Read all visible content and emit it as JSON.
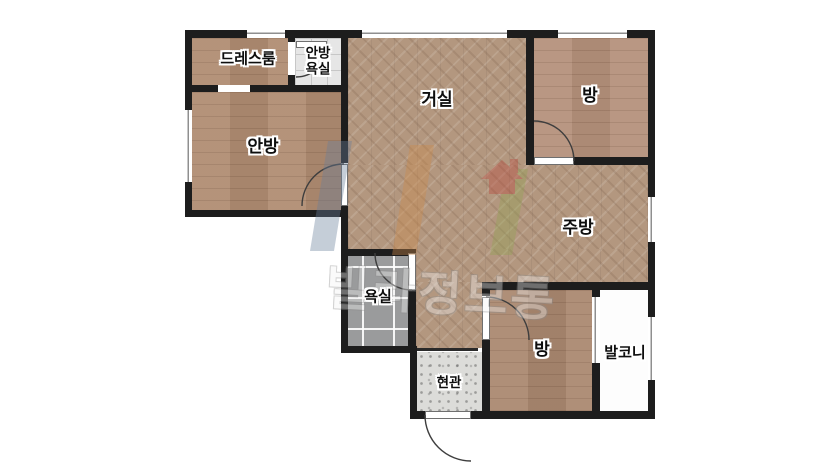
{
  "floorplan": {
    "rooms": [
      {
        "id": "dressroom",
        "label": "드레스룸",
        "floor": "wood-plank"
      },
      {
        "id": "master-bathroom",
        "label": "안방\n욕실",
        "floor": "white-tile"
      },
      {
        "id": "living-room",
        "label": "거실",
        "floor": "herringbone-wood"
      },
      {
        "id": "bedroom-ne",
        "label": "방",
        "floor": "wood-plank"
      },
      {
        "id": "master-bedroom",
        "label": "안방",
        "floor": "wood-plank"
      },
      {
        "id": "kitchen",
        "label": "주방",
        "floor": "herringbone-wood"
      },
      {
        "id": "bathroom",
        "label": "욕실",
        "floor": "gray-tile"
      },
      {
        "id": "bedroom-s",
        "label": "방",
        "floor": "wood-plank"
      },
      {
        "id": "balcony",
        "label": "발코니",
        "floor": "none"
      },
      {
        "id": "entrance",
        "label": "현관",
        "floor": "terrazzo"
      }
    ],
    "watermark": {
      "text": "빌라정보통"
    },
    "colors": {
      "wall": "#1d1d1d",
      "wood_plank": "#b08c72",
      "herringbone": "#b3977f",
      "gray_tile": "#9a9b9c",
      "white_tile": "#e6e6e6",
      "terrazzo": "#dcdcd9",
      "watermark_house": "#b9473c",
      "watermark_blue": "#6a7f9b",
      "watermark_orange": "#cd8a4b",
      "watermark_green": "#93a455"
    }
  }
}
